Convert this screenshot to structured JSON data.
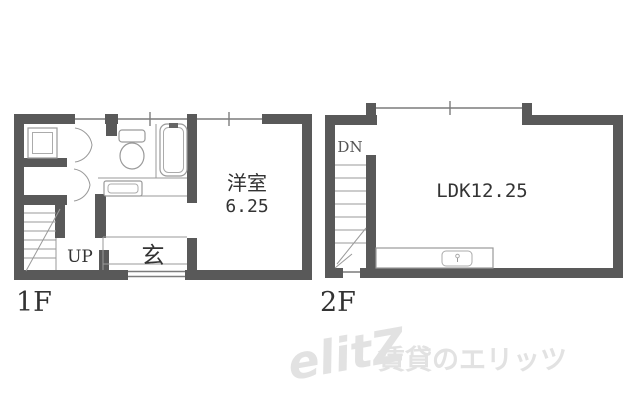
{
  "image": {
    "width": 640,
    "height": 416,
    "background": "#ffffff"
  },
  "colors": {
    "wall": "#595959",
    "thin_line": "#9a9a9a",
    "window_line": "#7c7c7c",
    "text": "#333333",
    "watermark": "#e2e2e2"
  },
  "floor1": {
    "floor_label": "1F",
    "room": {
      "name": "洋室",
      "size": "6.25"
    },
    "entrance_label": "玄",
    "stairs_label": "UP",
    "fixtures": [
      "shower-pan",
      "toilet",
      "bathtub",
      "washbasin-counter",
      "stairs-up",
      "entrance-step"
    ]
  },
  "floor2": {
    "floor_label": "2F",
    "room": {
      "name_size": "LDK12.25"
    },
    "stairs_label": "DN",
    "fixtures": [
      "stairs-down",
      "kitchen-counter",
      "kitchen-sink"
    ]
  },
  "watermark": {
    "logo": "elitZ",
    "text": "賃貸のエリッツ"
  }
}
